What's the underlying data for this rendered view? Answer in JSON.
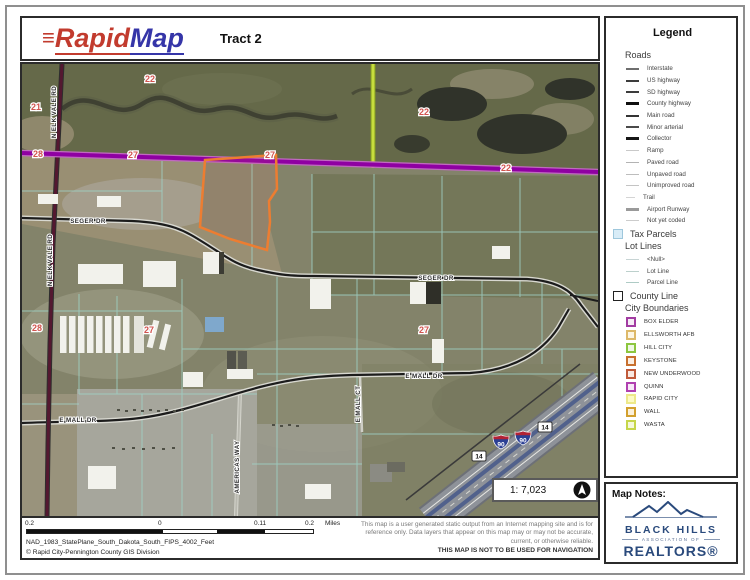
{
  "header": {
    "logo_mark": "≡",
    "logo_rapid": "Rapid",
    "logo_map": "Map",
    "title": "Tract 2"
  },
  "legend": {
    "title": "Legend",
    "roads_header": "Roads",
    "road_items": [
      {
        "label": "Interstate"
      },
      {
        "label": "US highway"
      },
      {
        "label": "SD highway"
      },
      {
        "label": "County highway"
      },
      {
        "label": "Main road"
      },
      {
        "label": "Minor arterial"
      },
      {
        "label": "Collector"
      },
      {
        "label": "Ramp"
      },
      {
        "label": "Paved road"
      },
      {
        "label": "Unpaved road"
      },
      {
        "label": "Unimproved road"
      },
      {
        "label": "Trail"
      },
      {
        "label": "Airport Runway"
      },
      {
        "label": "Not yet coded"
      }
    ],
    "tax_parcels_label": "Tax Parcels",
    "tax_parcels_fill": "#d8ecf7",
    "lot_lines_header": "Lot Lines",
    "lot_line_items": [
      {
        "label": "<Null>"
      },
      {
        "label": "Lot Line"
      },
      {
        "label": "Parcel Line"
      }
    ],
    "county_line_label": "County Line",
    "city_boundaries_header": "City Boundaries",
    "cities": [
      {
        "label": "BOX ELDER",
        "border": "#A23CA2",
        "fill": "#f6ecf6"
      },
      {
        "label": "ELLSWORTH AFB",
        "border": "#DDB96A",
        "fill": "#fdf6e4"
      },
      {
        "label": "HILL CITY",
        "border": "#8CC63F",
        "fill": "#eef7e4"
      },
      {
        "label": "KEYSTONE",
        "border": "#C8702E",
        "fill": "#fbeee2"
      },
      {
        "label": "NEW UNDERWOOD",
        "border": "#C05A3A",
        "fill": "#f9e9e2"
      },
      {
        "label": "QUINN",
        "border": "#B040B0",
        "fill": "#f7e8f7"
      },
      {
        "label": "RAPID CITY",
        "border": "#EDE98A",
        "fill": "#fcfbc5"
      },
      {
        "label": "WALL",
        "border": "#D2A02E",
        "fill": "#fbf0da"
      },
      {
        "label": "WASTA",
        "border": "#C6D64A",
        "fill": "#f4f8da"
      }
    ]
  },
  "map": {
    "section_labels": [
      {
        "text": "22"
      },
      {
        "text": "21"
      },
      {
        "text": "28"
      },
      {
        "text": "27"
      },
      {
        "text": "27"
      },
      {
        "text": "22"
      },
      {
        "text": "22"
      },
      {
        "text": "28"
      },
      {
        "text": "27"
      },
      {
        "text": "27"
      }
    ],
    "street_labels": [
      {
        "text": "N ELK VALE RD"
      },
      {
        "text": "N ELK VALE RD"
      },
      {
        "text": "SEGER DR"
      },
      {
        "text": "SEGER DR"
      },
      {
        "text": "E MALL DR"
      },
      {
        "text": "E MALL DR"
      },
      {
        "text": "E MALL CT"
      },
      {
        "text": "AMERICAS WAY"
      }
    ],
    "shields": {
      "interstate_90": "90",
      "route_14": "14"
    },
    "scale_ratio": "1: 7,023",
    "colors": {
      "highway_purple": "#8f00a2",
      "sd_highway_green": "#c7dd3d",
      "tract_outline_orange": "#ed7d31",
      "parcel_line_teal": "#9fd0c4"
    }
  },
  "map_notes": {
    "title": "Map Notes:",
    "realtors_logo": {
      "name": "BLACK HILLS",
      "sub": "ASSOCIATION OF",
      "brand": "REALTORS®"
    }
  },
  "footer": {
    "scale_labels": [
      {
        "text": "0.2"
      },
      {
        "text": "0"
      },
      {
        "text": "0.11"
      },
      {
        "text": "0.2"
      }
    ],
    "units": "Miles",
    "projection": "NAD_1983_StatePlane_South_Dakota_South_FIPS_4002_Feet",
    "copyright": "© Rapid City-Pennington County GIS Division",
    "disclaimer": {
      "line1": "This map is a user generated static output from an Internet mapping site and is for",
      "line2": "reference only. Data layers that appear on this map may or may not be accurate,",
      "line3": "current, or otherwise reliable.",
      "bold": "THIS MAP IS NOT TO BE USED FOR NAVIGATION"
    }
  }
}
